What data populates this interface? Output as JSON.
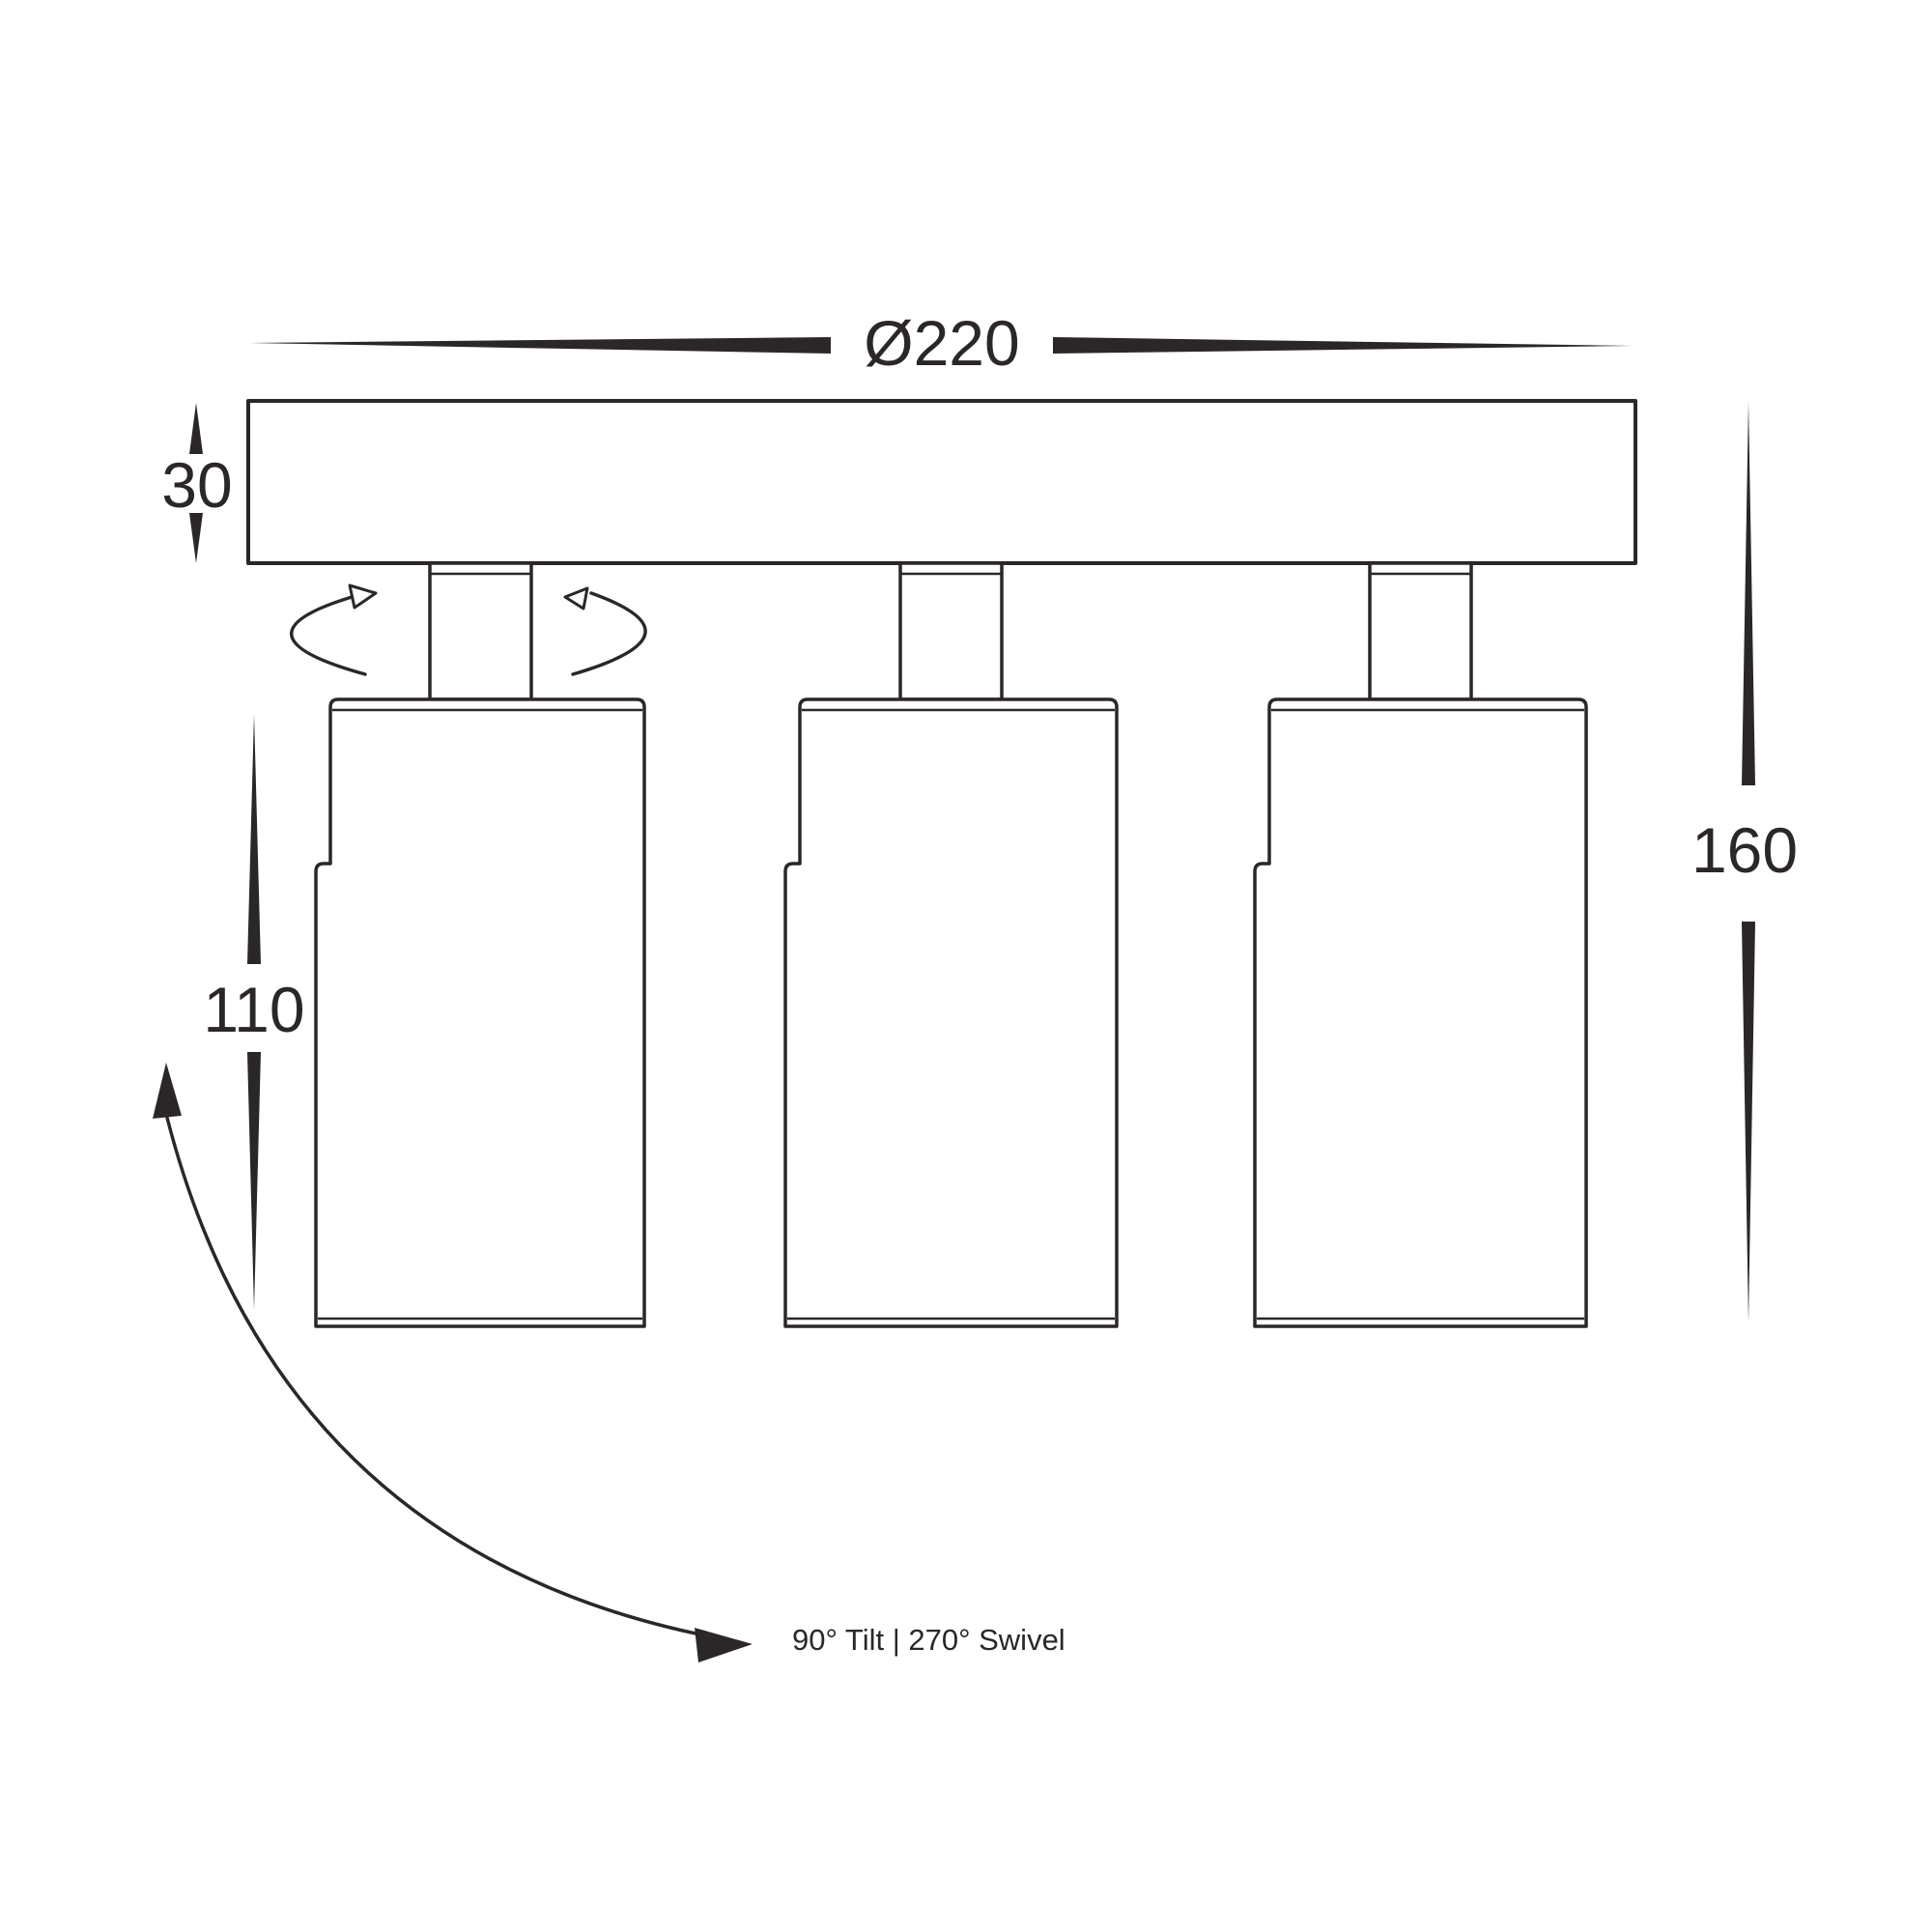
{
  "drawing": {
    "labels": {
      "diameter": "Ø220",
      "plate_thickness": "30",
      "body_length": "110",
      "overall_height": "160",
      "motion_note": "90° Tilt | 270° Swivel"
    },
    "colors": {
      "line": "#2b2728",
      "background": "#ffffff"
    }
  }
}
